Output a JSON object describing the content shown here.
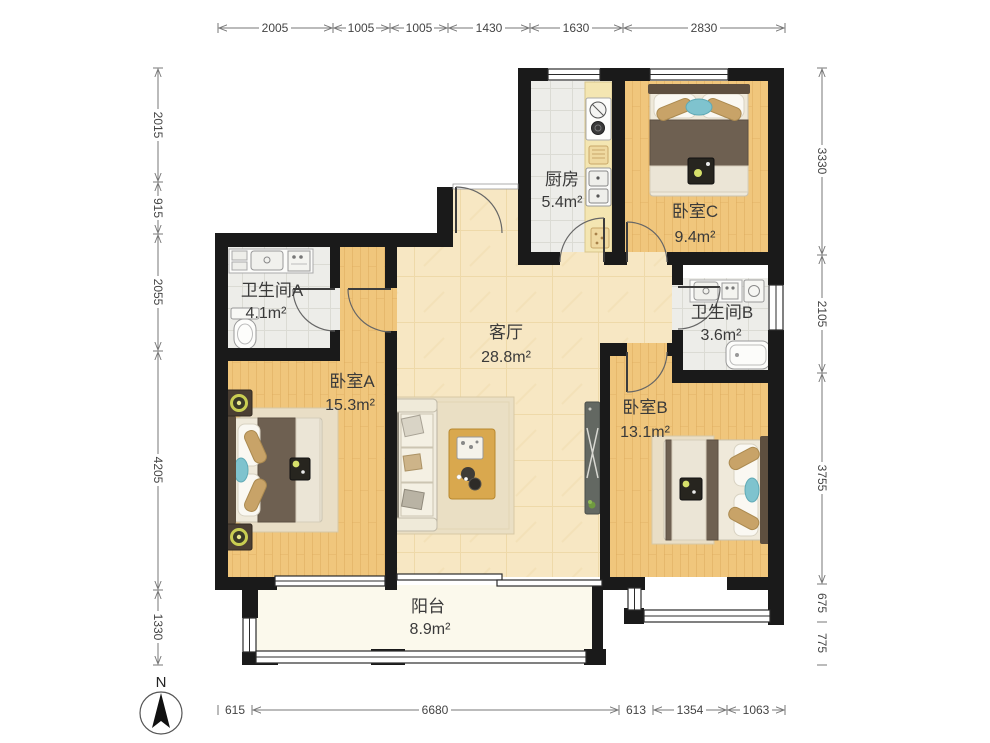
{
  "plan": {
    "rooms": {
      "kitchen": {
        "name": "厨房",
        "area": "5.4m²"
      },
      "bedroomC": {
        "name": "卧室C",
        "area": "9.4m²"
      },
      "bathA": {
        "name": "卫生间A",
        "area": "4.1m²"
      },
      "living": {
        "name": "客厅",
        "area": "28.8m²"
      },
      "bathB": {
        "name": "卫生间B",
        "area": "3.6m²"
      },
      "bedroomA": {
        "name": "卧室A",
        "area": "15.3m²"
      },
      "bedroomB": {
        "name": "卧室B",
        "area": "13.1m²"
      },
      "balcony": {
        "name": "阳台",
        "area": "8.9m²"
      }
    },
    "compass_label": "N",
    "dimensions": {
      "top": [
        "2005",
        "1005",
        "1005",
        "1430",
        "1630",
        "2830"
      ],
      "left": [
        "2015",
        "915",
        "2055",
        "4205",
        "1330"
      ],
      "right": [
        "3330",
        "2105",
        "3755",
        "675",
        "775"
      ],
      "bottom": [
        "615",
        "6680",
        "613",
        "1354",
        "1063"
      ]
    },
    "colors": {
      "wall": "#1a1a1a",
      "bedroom_floor": "#f0c67c",
      "living_floor": "#f7e7c3",
      "wet_room_floor": "#ededE9",
      "balcony_floor": "#fbf9ec",
      "counter": "#f4e6b2",
      "blanket_brown": "#6e6051",
      "cushion_tan": "#c8a368",
      "pillow_blue": "#7fc3ce",
      "lamp_green": "#d6e06a"
    }
  }
}
